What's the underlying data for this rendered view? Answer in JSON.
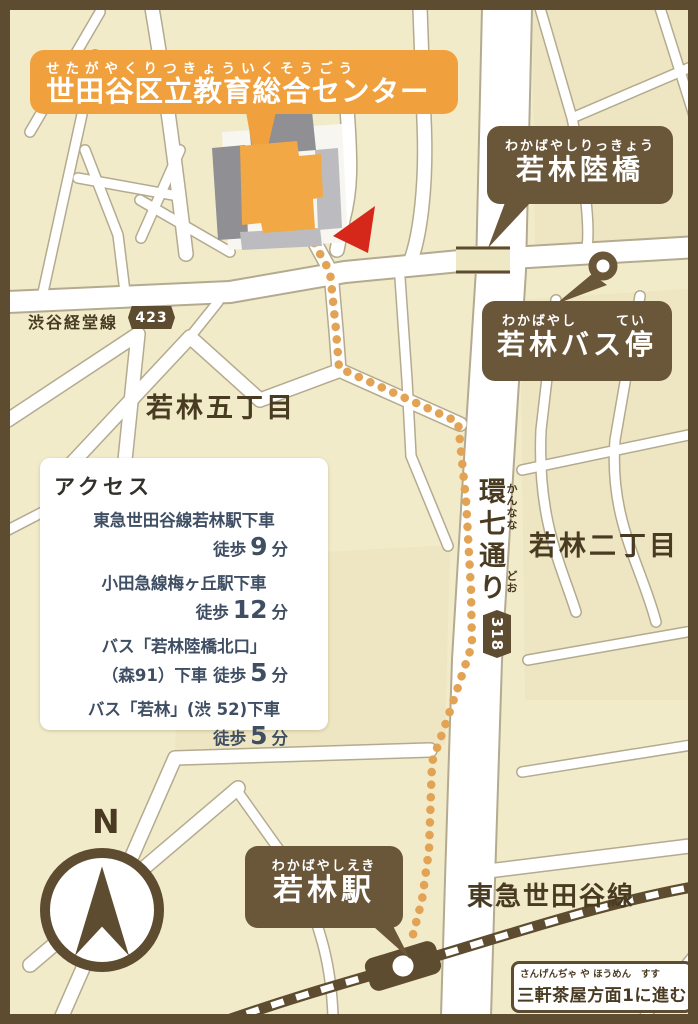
{
  "title_banner": {
    "furigana": "せたがやくりつきょういくそうごう",
    "title": "世田谷区立教育総合センター"
  },
  "labels": {
    "rikkyo": {
      "furigana": "わかばやしりっきょう",
      "title": "若林陸橋"
    },
    "bus_stop": {
      "furigana_left": "わかばやし",
      "furigana_right": "てい",
      "title": "若林バス停"
    },
    "shibuya_keido": {
      "name": "渋谷経堂線",
      "route_no": "423"
    },
    "wakabayashi5": "若林五丁目",
    "wakabayashi2": "若林二丁目",
    "kannana": {
      "furigana_1": "かんなな",
      "furigana_2": "どお",
      "title": "環七通り",
      "route_no": "318"
    },
    "station": {
      "furigana": "わかばやしえき",
      "title": "若林駅"
    },
    "tokyu_line": "東急世田谷線",
    "sangenjaya": {
      "furigana_left": "さんげんぢゃ や ほうめん",
      "furigana_right": "すす",
      "title": "三軒茶屋方面1に進む"
    },
    "compass_north": "N"
  },
  "access": {
    "title": "アクセス",
    "items": [
      {
        "line1": "東急世田谷線若林駅下車",
        "line2_pre": "徒歩",
        "num": "9",
        "unit": "分"
      },
      {
        "line1": "小田急線梅ヶ丘駅下車",
        "line2_pre": "徒歩",
        "num": "12",
        "unit": "分"
      },
      {
        "line1": "バス「若林陸橋北口」",
        "line2_pre": "（森91）下車 徒歩",
        "num": "5",
        "unit": "分"
      },
      {
        "line1": "バス「若林」(渋 52)下車",
        "line2_pre": "徒歩",
        "num": "5",
        "unit": "分"
      }
    ]
  },
  "colors": {
    "frame_brown": "#5e4c31",
    "bubble_brown": "#6a5639",
    "banner_orange": "#f0a13e",
    "building_orange": "#f2a844",
    "map_beige": "#f1ebca",
    "road_white": "#ffffff",
    "route_dot_orange": "#e3a355",
    "arrow_red": "#d6281a",
    "access_text_blue": "#3f4e63",
    "map_label_brown": "#493b22"
  }
}
